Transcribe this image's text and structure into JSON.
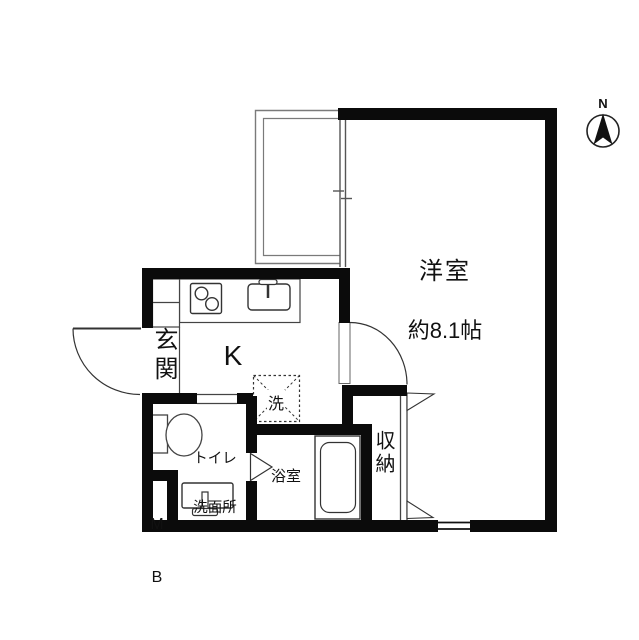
{
  "title": "floor-plan",
  "colors": {
    "wall": "#0b0b0b",
    "fixture_line": "#333333",
    "thin_line": "#777777",
    "background": "#ffffff"
  },
  "compass": {
    "label": "N"
  },
  "rooms": {
    "western_room": {
      "name": "洋室",
      "size": "約8.1帖"
    },
    "kitchen": {
      "name": "K"
    },
    "entrance": {
      "name": "玄関"
    },
    "laundry": {
      "name": "洗"
    },
    "washroom": {
      "line1": "トイレ",
      "line2": "洗面所"
    },
    "meter_box": {
      "line1": "M",
      "line2": "B"
    },
    "bathroom": {
      "name": "浴室"
    },
    "closet": {
      "name": "収納"
    }
  },
  "fixtures": [
    "kitchen-stove",
    "kitchen-sink",
    "toilet",
    "washbasin",
    "bathtub",
    "laundry-area",
    "balcony",
    "entrance-door",
    "room-door",
    "closet-doors",
    "bathroom-door",
    "window"
  ]
}
